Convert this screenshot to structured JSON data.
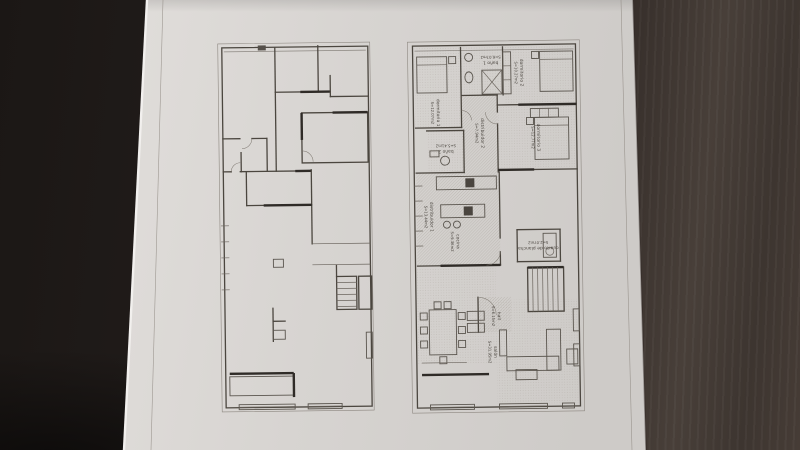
{
  "scene": {
    "colors": {
      "table_dark": "#211c1a",
      "table_wood": "#483f39",
      "paper": "#d8d5d2",
      "paper_highlight": "#f2f0ee",
      "ink": "#4b463f",
      "wall_dark": "#2f2b27",
      "hatch": "#a39d94"
    }
  },
  "plans": {
    "left": {
      "name": "existing-state-plan",
      "rooms": []
    },
    "right": {
      "name": "furnished-reform-plan",
      "rooms": [
        {
          "label": "dormitorio 1",
          "area": "S=12.07m2"
        },
        {
          "label": "baño 1",
          "area": "S=6.07m2"
        },
        {
          "label": "dormitorio 2",
          "area": "S=10.27m2"
        },
        {
          "label": "dormitorio 3",
          "area": "S=12.77m2"
        },
        {
          "label": "baño 2",
          "area": "S=5.41m2"
        },
        {
          "label": "distribuidor 2",
          "area": "S=7.94m2"
        },
        {
          "label": "distribuidor 1",
          "area": "S=13.44m2"
        },
        {
          "label": "cocina",
          "area": "S=9.36m2"
        },
        {
          "label": "cuarto de plancha",
          "area": "S=2.07m2"
        },
        {
          "label": "hall",
          "area": "S=6.15m2"
        },
        {
          "label": "salón",
          "area": "S=31.95m2"
        }
      ]
    }
  }
}
